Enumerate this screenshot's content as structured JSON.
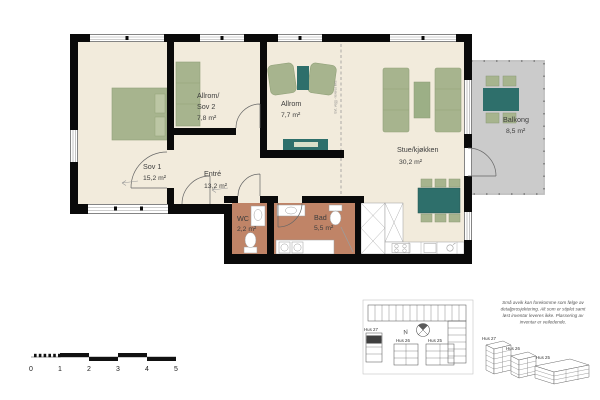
{
  "floorplan": {
    "rooms": {
      "sov1": {
        "name": "Sov 1",
        "area": "15,2 m²"
      },
      "allrom_sov2": {
        "name_line1": "Allrom/",
        "name_line2": "Sov 2",
        "area": "7,8 m²"
      },
      "allrom": {
        "name": "Allrom",
        "area": "7,7 m²"
      },
      "entre": {
        "name": "Entré",
        "area": "13,2 m²"
      },
      "wc": {
        "name": "WC",
        "area": "2,2 m²"
      },
      "bad": {
        "name": "Bad",
        "area": "5,5 m²"
      },
      "stue": {
        "name": "Stue/kjøkken",
        "area": "30,2 m²"
      },
      "balkong": {
        "name": "Balkong",
        "area": "8,5 m²"
      }
    },
    "dashed_wall_note": "Evt. vegg - leveres ikke"
  },
  "scale_bar": {
    "labels": [
      "0",
      "1",
      "2",
      "3",
      "4",
      "5"
    ]
  },
  "site_plan": {
    "north_label": "N",
    "hus27": "Hus 27",
    "hus26": "Hus 26",
    "hus25": "Hus 25"
  },
  "axonometric": {
    "hus27": "Hus 27",
    "hus26": "Hus 26",
    "hus25": "Hus 25"
  },
  "disclaimer": {
    "line1": "Små avvik kan forekomme som følge av",
    "line2": "detaljprosjektering. Alt som er stiplet samt",
    "line3": "løst inventar leveres ikke. Plassering av",
    "line4": "inventar er veiledende."
  },
  "colors": {
    "wall": "#0a0a0a",
    "floor": "#f2ebdc",
    "wet_room_floor": "#c08467",
    "furniture_green": "#a7b48e",
    "furniture_teal": "#2e6f6b",
    "balcony_gray": "#cbcbcb"
  }
}
